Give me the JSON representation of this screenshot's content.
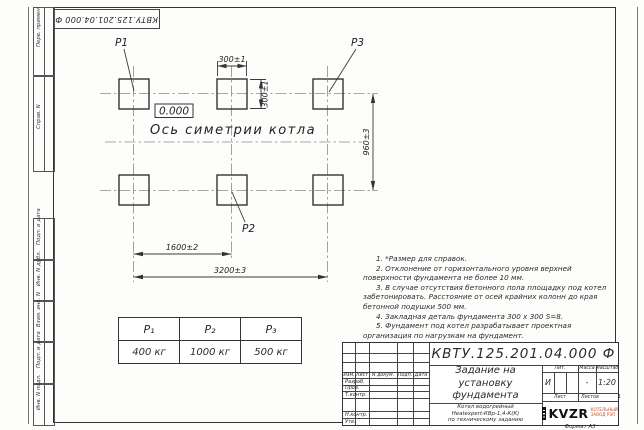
{
  "sheet": {
    "format_label": "Формат А3"
  },
  "stamp": {
    "doc_number_rotated": "КВТУ.125.201.04.000 Ф"
  },
  "side_labels": [
    "Перв. примен.",
    "Справ. N",
    "Подп. и дата",
    "Инв. N дубл.",
    "Взам. инв. N",
    "Подп. и дата",
    "Инв. N подл."
  ],
  "drawing": {
    "elevation": "0.000",
    "axis_label": "Ось симетрии котла",
    "points": {
      "p1": "P1",
      "p2": "P2",
      "p3": "P3"
    },
    "dims": {
      "pad_width": "300±1",
      "pad_height": "300±1",
      "row_spacing": "960±3",
      "col_spacing": "1600±2",
      "total_span": "3200±3"
    }
  },
  "load_table": {
    "headers": [
      "P₁",
      "P₂",
      "P₃"
    ],
    "values": [
      "400 кг",
      "1000 кг",
      "500 кг"
    ]
  },
  "notes": [
    "1. *Размер для справок.",
    "2. Отклонение от горизонтального уровня верхней поверхности фундамента не более 10 мм.",
    "3. В случае отсутствия бетонного пола площадку под котел забетонировать. Расстояние от осей крайних колонн до края бетонной подушки 500 мм.",
    "4. Закладная деталь фундамента 300 х 300 S=8.",
    "5. Фундамент под котел разрабатывает проектная организация по нагрузкам на фундамент."
  ],
  "title_block": {
    "doc_number": "КВТУ.125.201.04.000 Ф",
    "title_lines": [
      "Задание на",
      "установку",
      "фундамента"
    ],
    "subtitle_lines": [
      "Котел водогрейный",
      "Heatexpert-КВр-1,4-К(К)",
      "по техническому заданию"
    ],
    "rev_headers": [
      "Изм.",
      "Лист",
      "N докум.",
      "Подп.",
      "Дата"
    ],
    "sign_rows": [
      "Разраб.",
      "Пров.",
      "Т.контр.",
      "",
      "Н.контр.",
      "Утв."
    ],
    "lit_header": "Лит.",
    "mass_header": "Масса",
    "scale_header": "Масштаб",
    "lit_value": "И",
    "mass_value": "-",
    "scale_value": "1:20",
    "sheet_label": "Лист",
    "sheets_label": "Листов",
    "sheets_value": "1",
    "company": "KVZR",
    "company_sub": [
      "КОТЕЛЬНЫЙ",
      "ЗАВОД РЭП"
    ]
  }
}
